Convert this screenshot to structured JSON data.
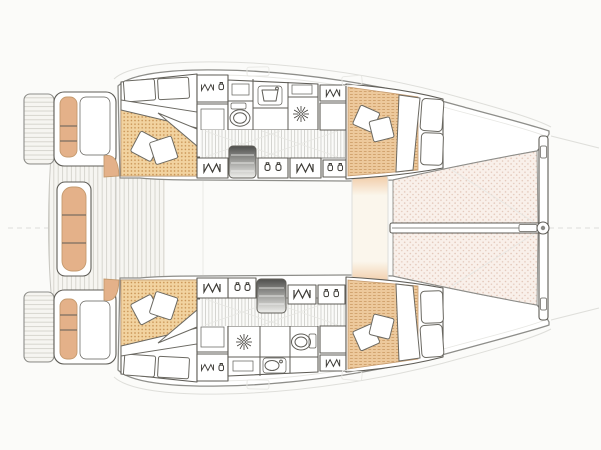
{
  "meta": {
    "label": "catamaran-accommodation-deck-plan"
  },
  "colors": {
    "background": "#fbfbf9",
    "wall": "#ffffff",
    "outline": "#8e8e8a",
    "outline_furn": "#5f5d57",
    "glyph": "#3d3b36",
    "faint": "#dededa",
    "pillow_stroke": "#6b6962",
    "cushion": "#e4b189",
    "cushion_stroke": "#c49a6e",
    "mattress_bg": "#f2d3a0",
    "mattress_dot": "#c58e4e",
    "fwdbed_bg": "#edc99c",
    "fwdbed_line": "#cfa06a",
    "tramp_bg": "#f9f0ea",
    "tramp_dot": "#e0c3b4",
    "teak_bg": "#f6f5f1",
    "teak_line": "#cfcec7",
    "corr_bg": "#fbfbf9",
    "corr_line": "#c4c4bf",
    "steps_dark": "#4f4f4d",
    "steps_mid": "#9a9a97",
    "steps_light": "#efefec",
    "lounge_glow": "#f0c69d",
    "lounge_cream": "#fbf6ec"
  },
  "icons": {
    "wardrobe": "hanger-zigzag-icon",
    "shelf": "jar-pair-icon",
    "shower": "starburst-drain-icon",
    "toilet": "toilet-oval-icon",
    "sink": "basin-icon",
    "steps": "companionway-steps-icon"
  }
}
